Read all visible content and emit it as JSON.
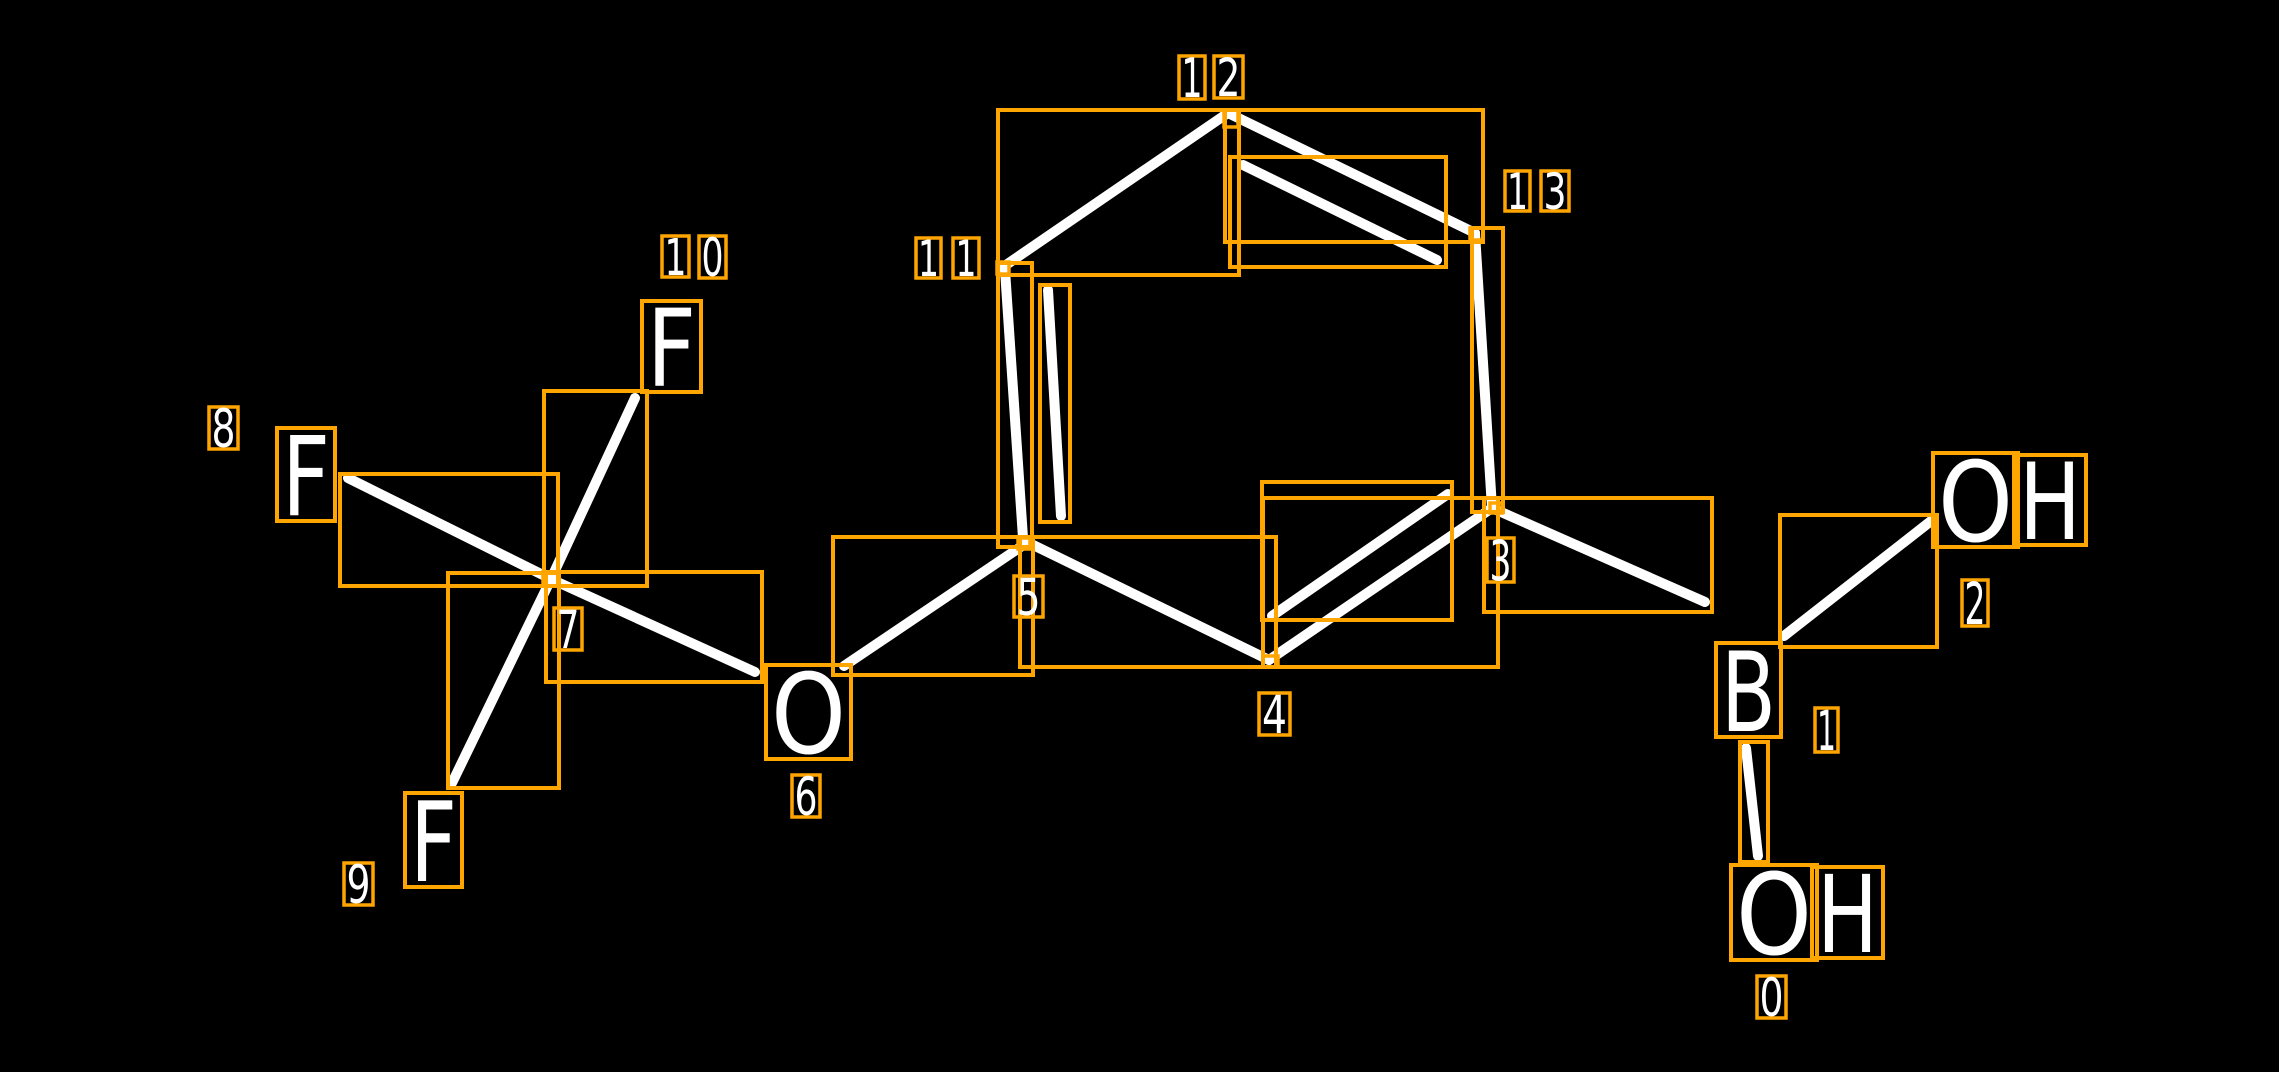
{
  "canvas": {
    "width": 2279,
    "height": 1072,
    "background": "#000000"
  },
  "colors": {
    "annotation_box": "#FFA500",
    "bond": "#FFFFFF",
    "label_text": "#FFFFFF"
  },
  "molecule": {
    "visible_atom_symbols": [
      "OH",
      "B",
      "OH",
      "O",
      "F",
      "F",
      "F"
    ],
    "atom_indices_shown": [
      "0",
      "1",
      "2",
      "3",
      "4",
      "5",
      "6",
      "7",
      "8",
      "9",
      "10",
      "11",
      "12",
      "13"
    ],
    "letters": [
      {
        "id": "O-0",
        "glyph": "O",
        "x": 1736,
        "y": 870,
        "w": 76,
        "h": 85
      },
      {
        "id": "H-0",
        "glyph": "H",
        "x": 1817,
        "y": 872,
        "w": 61,
        "h": 81
      },
      {
        "id": "B-1",
        "glyph": "B",
        "x": 1721,
        "y": 648,
        "w": 55,
        "h": 84
      },
      {
        "id": "O-2",
        "glyph": "O",
        "x": 1938,
        "y": 458,
        "w": 75,
        "h": 84
      },
      {
        "id": "H-2",
        "glyph": "H",
        "x": 2019,
        "y": 460,
        "w": 62,
        "h": 80
      },
      {
        "id": "O-6",
        "glyph": "O",
        "x": 771,
        "y": 670,
        "w": 75,
        "h": 84
      },
      {
        "id": "F-8",
        "glyph": "F",
        "x": 282,
        "y": 433,
        "w": 48,
        "h": 83
      },
      {
        "id": "F-9",
        "glyph": "F",
        "x": 410,
        "y": 798,
        "w": 47,
        "h": 84
      },
      {
        "id": "F-10",
        "glyph": "F",
        "x": 647,
        "y": 306,
        "w": 49,
        "h": 81
      }
    ],
    "index_labels": [
      {
        "atom": "0",
        "digits": [
          {
            "t": "0",
            "x": 1757,
            "y": 976,
            "w": 29,
            "h": 42
          }
        ]
      },
      {
        "atom": "1",
        "digits": [
          {
            "t": "1",
            "x": 1815,
            "y": 708,
            "w": 23,
            "h": 44
          }
        ]
      },
      {
        "atom": "2",
        "digits": [
          {
            "t": "2",
            "x": 1962,
            "y": 580,
            "w": 26,
            "h": 46
          }
        ]
      },
      {
        "atom": "3",
        "digits": [
          {
            "t": "3",
            "x": 1487,
            "y": 538,
            "w": 27,
            "h": 44
          }
        ]
      },
      {
        "atom": "4",
        "digits": [
          {
            "t": "4",
            "x": 1259,
            "y": 693,
            "w": 31,
            "h": 42
          }
        ]
      },
      {
        "atom": "5",
        "digits": [
          {
            "t": "5",
            "x": 1014,
            "y": 576,
            "w": 29,
            "h": 41
          }
        ]
      },
      {
        "atom": "6",
        "digits": [
          {
            "t": "6",
            "x": 792,
            "y": 775,
            "w": 28,
            "h": 42
          }
        ]
      },
      {
        "atom": "7",
        "digits": [
          {
            "t": "7",
            "x": 554,
            "y": 608,
            "w": 28,
            "h": 42
          }
        ]
      },
      {
        "atom": "8",
        "digits": [
          {
            "t": "8",
            "x": 209,
            "y": 407,
            "w": 29,
            "h": 42
          }
        ]
      },
      {
        "atom": "9",
        "digits": [
          {
            "t": "9",
            "x": 344,
            "y": 863,
            "w": 29,
            "h": 42
          }
        ]
      },
      {
        "atom": "10",
        "digits": [
          {
            "t": "1",
            "x": 662,
            "y": 236,
            "w": 27,
            "h": 41
          },
          {
            "t": "0",
            "x": 699,
            "y": 236,
            "w": 27,
            "h": 42
          }
        ]
      },
      {
        "atom": "11",
        "digits": [
          {
            "t": "1",
            "x": 916,
            "y": 238,
            "w": 25,
            "h": 40
          },
          {
            "t": "1",
            "x": 953,
            "y": 238,
            "w": 26,
            "h": 40
          }
        ]
      },
      {
        "atom": "12",
        "digits": [
          {
            "t": "1",
            "x": 1179,
            "y": 56,
            "w": 26,
            "h": 43
          },
          {
            "t": "2",
            "x": 1214,
            "y": 56,
            "w": 29,
            "h": 42
          }
        ]
      },
      {
        "atom": "13",
        "digits": [
          {
            "t": "1",
            "x": 1505,
            "y": 171,
            "w": 25,
            "h": 40
          },
          {
            "t": "3",
            "x": 1541,
            "y": 171,
            "w": 28,
            "h": 40
          }
        ]
      }
    ],
    "bonds": [
      {
        "id": "11-12",
        "x1": 1003,
        "y1": 267,
        "x2": 1228,
        "y2": 113
      },
      {
        "id": "12-13",
        "x1": 1228,
        "y1": 113,
        "x2": 1475,
        "y2": 233
      },
      {
        "id": "12-13-inner",
        "x1": 1243,
        "y1": 165,
        "x2": 1437,
        "y2": 260
      },
      {
        "id": "13-3",
        "x1": 1475,
        "y1": 233,
        "x2": 1492,
        "y2": 508
      },
      {
        "id": "11-5",
        "x1": 1005,
        "y1": 270,
        "x2": 1023,
        "y2": 538
      },
      {
        "id": "11-5-inner",
        "x1": 1048,
        "y1": 290,
        "x2": 1061,
        "y2": 516
      },
      {
        "id": "5-6",
        "x1": 1022,
        "y1": 546,
        "x2": 844,
        "y2": 666
      },
      {
        "id": "6-7",
        "x1": 755,
        "y1": 672,
        "x2": 553,
        "y2": 580
      },
      {
        "id": "7-8",
        "x1": 551,
        "y1": 579,
        "x2": 348,
        "y2": 478
      },
      {
        "id": "7-9",
        "x1": 551,
        "y1": 579,
        "x2": 452,
        "y2": 783
      },
      {
        "id": "7-10",
        "x1": 551,
        "y1": 579,
        "x2": 635,
        "y2": 398
      },
      {
        "id": "5-4",
        "x1": 1027,
        "y1": 542,
        "x2": 1269,
        "y2": 660
      },
      {
        "id": "4-3",
        "x1": 1269,
        "y1": 660,
        "x2": 1492,
        "y2": 508
      },
      {
        "id": "4-3-inner",
        "x1": 1272,
        "y1": 616,
        "x2": 1448,
        "y2": 494
      },
      {
        "id": "3-B",
        "x1": 1492,
        "y1": 508,
        "x2": 1705,
        "y2": 602
      },
      {
        "id": "B-OH2",
        "x1": 1784,
        "y1": 636,
        "x2": 1931,
        "y2": 521
      },
      {
        "id": "B-OH0",
        "x1": 1746,
        "y1": 748,
        "x2": 1758,
        "y2": 856
      }
    ],
    "bond_boxes": [
      {
        "id": "11-12",
        "x": 998,
        "y": 110,
        "w": 241,
        "h": 165
      },
      {
        "id": "12-13",
        "x": 1225,
        "y": 110,
        "w": 258,
        "h": 132
      },
      {
        "id": "12-13-inner",
        "x": 1230,
        "y": 157,
        "w": 216,
        "h": 110
      },
      {
        "id": "13-3",
        "x": 1472,
        "y": 228,
        "w": 31,
        "h": 284
      },
      {
        "id": "11-5",
        "x": 998,
        "y": 263,
        "w": 34,
        "h": 284
      },
      {
        "id": "11-5-inner",
        "x": 1040,
        "y": 285,
        "w": 30,
        "h": 237
      },
      {
        "id": "5-6",
        "x": 833,
        "y": 537,
        "w": 200,
        "h": 138
      },
      {
        "id": "6-7",
        "x": 546,
        "y": 572,
        "w": 216,
        "h": 110
      },
      {
        "id": "7-8",
        "x": 340,
        "y": 474,
        "w": 218,
        "h": 112
      },
      {
        "id": "7-9",
        "x": 448,
        "y": 573,
        "w": 111,
        "h": 215
      },
      {
        "id": "7-10",
        "x": 544,
        "y": 391,
        "w": 103,
        "h": 195
      },
      {
        "id": "5-4",
        "x": 1020,
        "y": 537,
        "w": 256,
        "h": 130
      },
      {
        "id": "4-3",
        "x": 1263,
        "y": 498,
        "w": 235,
        "h": 169
      },
      {
        "id": "4-3-inner",
        "x": 1262,
        "y": 482,
        "w": 190,
        "h": 138
      },
      {
        "id": "3-B",
        "x": 1484,
        "y": 498,
        "w": 228,
        "h": 114
      },
      {
        "id": "B-OH2",
        "x": 1780,
        "y": 515,
        "w": 157,
        "h": 132
      },
      {
        "id": "B-OH0",
        "x": 1740,
        "y": 742,
        "w": 28,
        "h": 120
      }
    ],
    "vertex_boxes": [
      {
        "id": "12",
        "x": 1224,
        "y": 110,
        "w": 14,
        "h": 17
      },
      {
        "id": "11",
        "x": 997,
        "y": 262,
        "w": 12,
        "h": 12
      },
      {
        "id": "13",
        "x": 1470,
        "y": 228,
        "w": 13,
        "h": 12
      },
      {
        "id": "3",
        "x": 1490,
        "y": 503,
        "w": 12,
        "h": 10
      },
      {
        "id": "5",
        "x": 1018,
        "y": 538,
        "w": 12,
        "h": 11
      },
      {
        "id": "4",
        "x": 1263,
        "y": 656,
        "w": 15,
        "h": 11
      },
      {
        "id": "7",
        "x": 543,
        "y": 572,
        "w": 15,
        "h": 14
      }
    ]
  }
}
